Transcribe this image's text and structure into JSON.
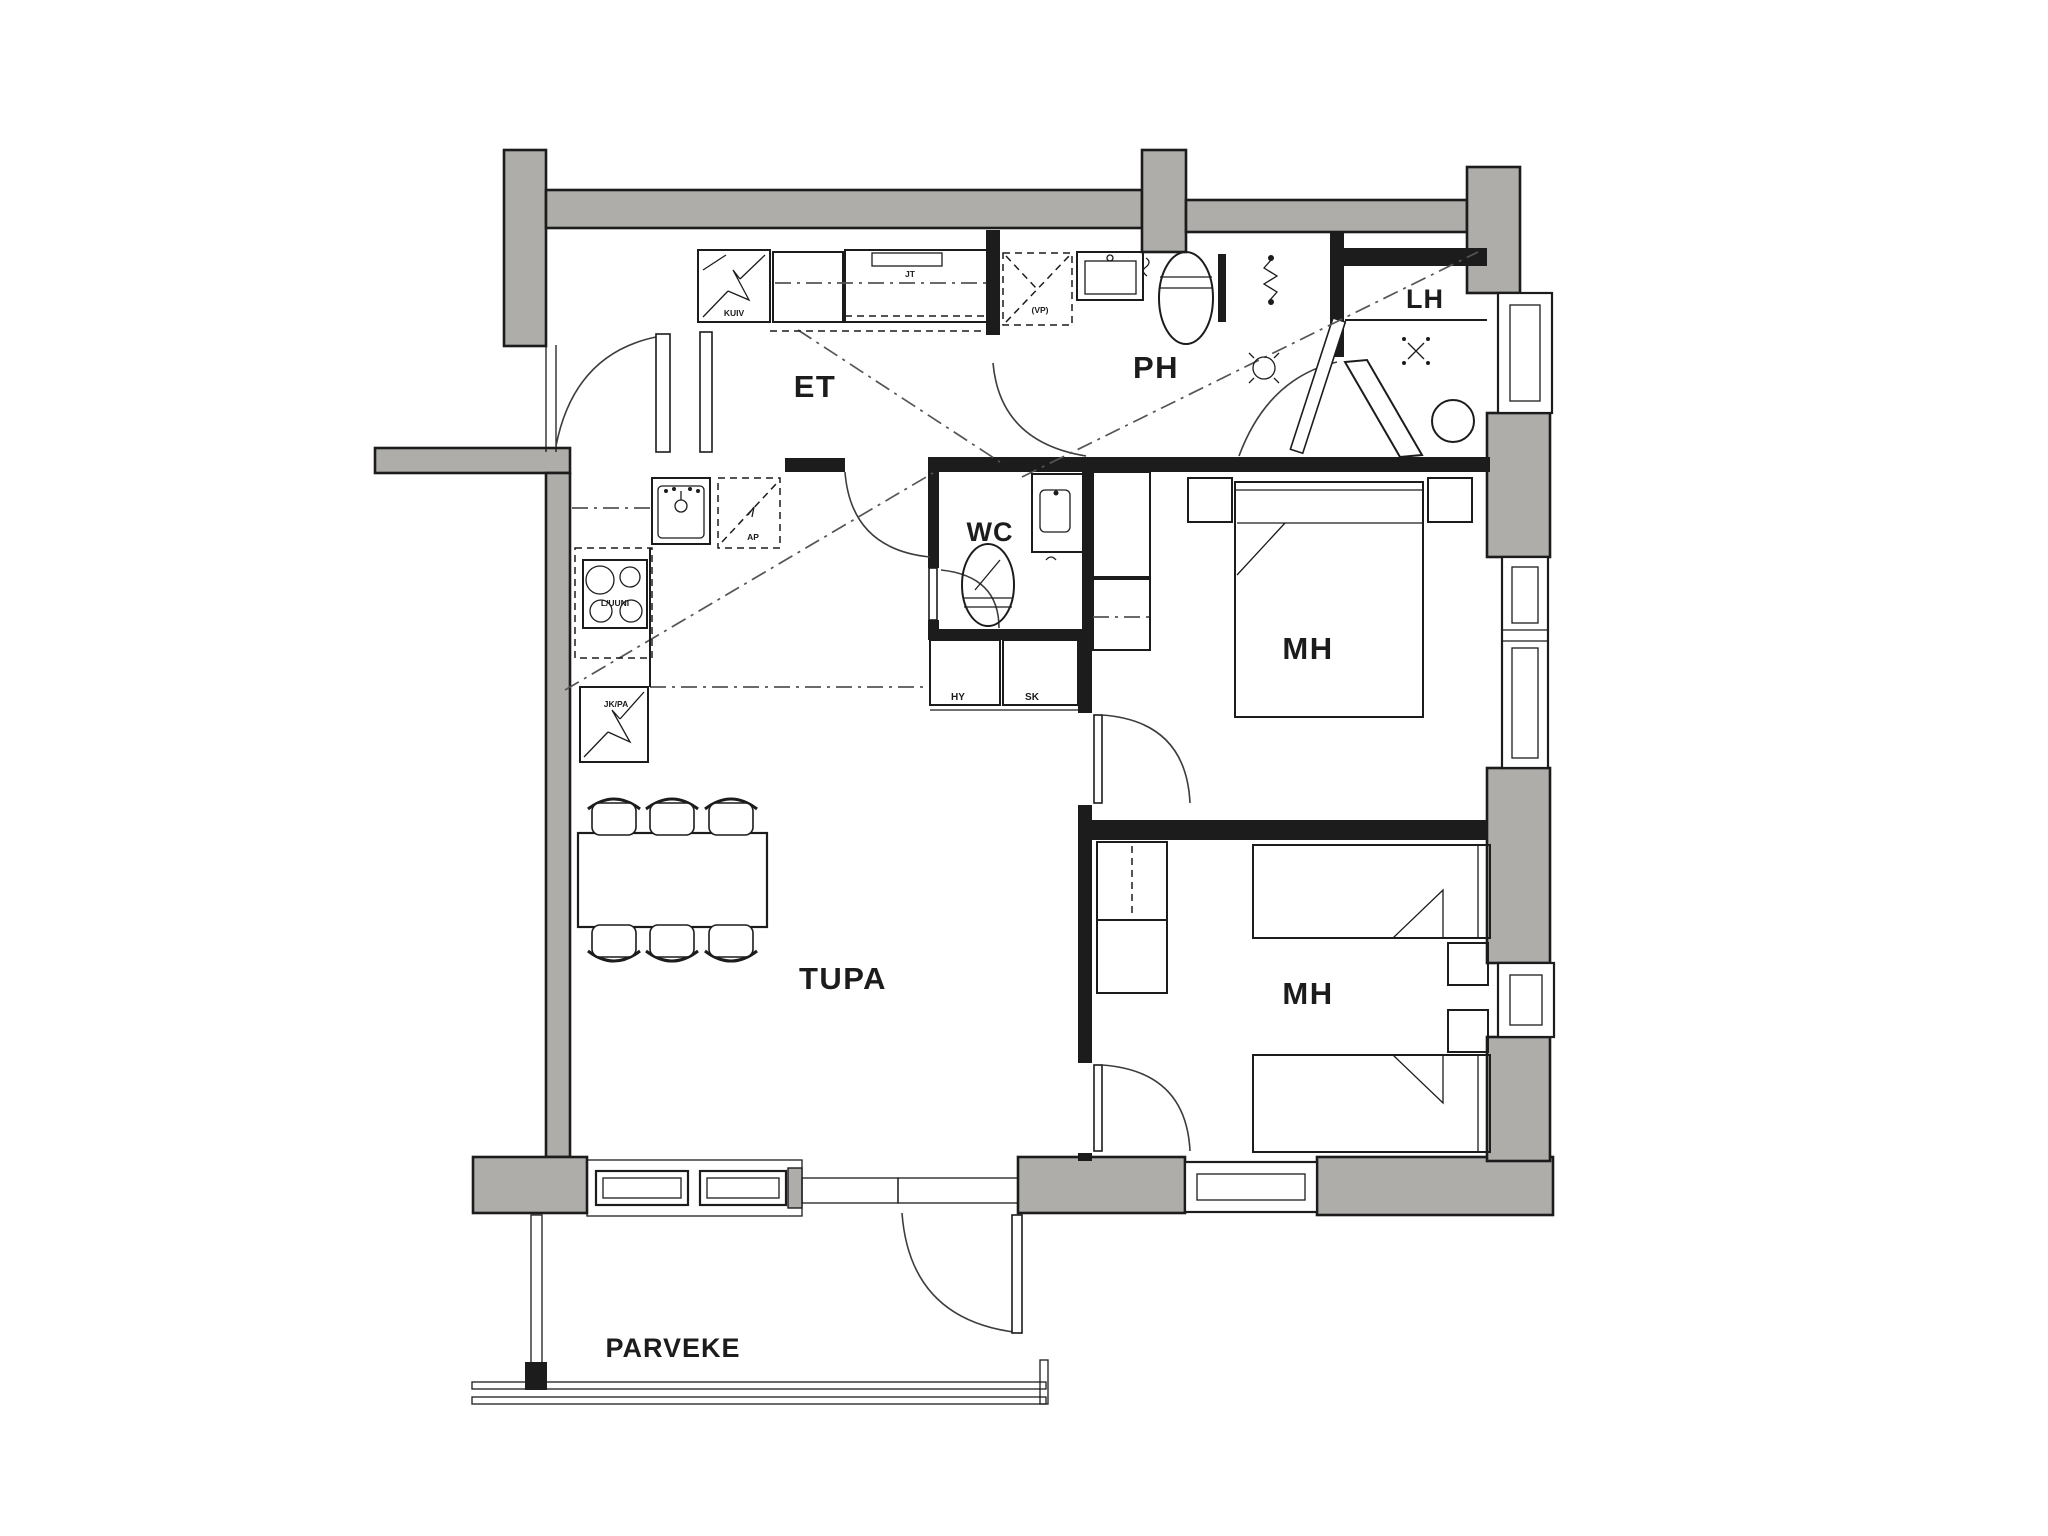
{
  "colors": {
    "wall": "#aeadaa",
    "line": "#1c1c1c",
    "dash": "#555555",
    "bg": "#ffffff"
  },
  "rooms": {
    "et": "ET",
    "ph": "PH",
    "lh": "LH",
    "wc": "WC",
    "mh_top": "MH",
    "mh_bottom": "MH",
    "tupa": "TUPA",
    "parveke": "PARVEKE"
  },
  "fixtures": {
    "drying_cabinet": "KUIV",
    "coat_shelf": "JT",
    "shower_reservation": "(VP)",
    "dishwasher": "AP",
    "stove": "L/UUNI",
    "fridge_freezer": "JK/PA",
    "cabinet_hy": "HY",
    "cabinet_sk": "SK"
  }
}
